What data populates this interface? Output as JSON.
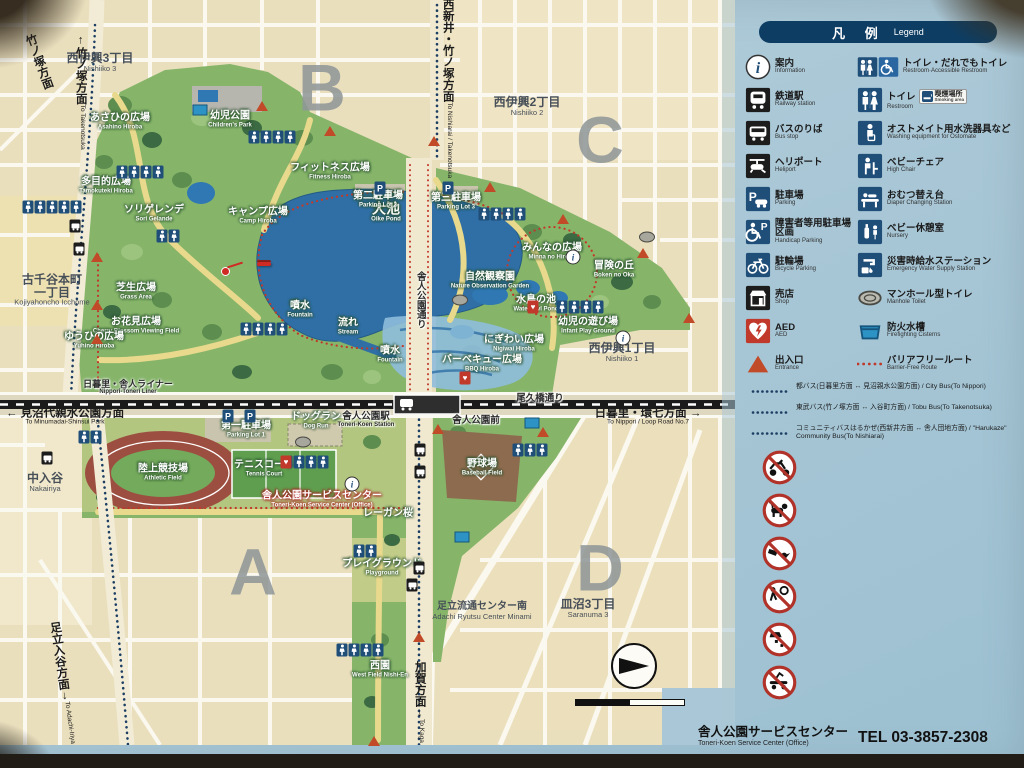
{
  "colors": {
    "accent_navy": "#0d3d63",
    "icon_blue": "#1f4e79",
    "icon_black": "#1c1c1c",
    "alert_red": "#c0392b",
    "prohibit_red": "#b03228",
    "entrance_orange": "#c14b28",
    "park_green": "#86b56a",
    "water_blue": "#2f6fa5",
    "map_cream": "#eadfbd",
    "sign_blue": "#a9c7d6",
    "route_red": "#c0392b",
    "route_navy": "#1c3e63"
  },
  "legend": {
    "title_jp": "凡 例",
    "title_en": "Legend",
    "left_items": [
      {
        "icon": "info",
        "jp": "案内",
        "en": "Information"
      },
      {
        "icon": "train",
        "jp": "鉄道駅",
        "en": "Railway station"
      },
      {
        "icon": "bus",
        "jp": "バスのりば",
        "en": "Bus stop"
      },
      {
        "icon": "heliport",
        "jp": "ヘリポート",
        "en": "Heliport"
      },
      {
        "icon": "parking",
        "jp": "駐車場",
        "en": "Parking"
      },
      {
        "icon": "handicap-parking",
        "jp": "障害者等用駐車場区画",
        "en": "Handicap Parking"
      },
      {
        "icon": "bicycle-parking",
        "jp": "駐輪場",
        "en": "Bicycle Parking"
      },
      {
        "icon": "shop",
        "jp": "売店",
        "en": "Shop"
      },
      {
        "icon": "aed",
        "jp": "AED",
        "en": "AED"
      },
      {
        "icon": "entrance",
        "jp": "出入口",
        "en": "Entrance"
      }
    ],
    "right_items": [
      {
        "icon": "restroom-accessible",
        "jp": "トイレ・だれでもトイレ",
        "en": "Restroom·Accessible Restroom"
      },
      {
        "icon": "restroom",
        "jp": "トイレ",
        "en": "Restroom",
        "badge_jp": "喫煙場所",
        "badge_en": "Smoking area"
      },
      {
        "icon": "ostomate",
        "jp": "オストメイト用水洗器具など",
        "en": "Washing equipment for Ostomate"
      },
      {
        "icon": "high-chair",
        "jp": "ベビーチェア",
        "en": "High Chair"
      },
      {
        "icon": "diaper",
        "jp": "おむつ替え台",
        "en": "Diaper Changing Station"
      },
      {
        "icon": "nursery",
        "jp": "ベビー休憩室",
        "en": "Nursery"
      },
      {
        "icon": "water-station",
        "jp": "災害時給水ステーション",
        "en": "Emergency Water Supply Station"
      },
      {
        "icon": "manhole-toilet",
        "jp": "マンホール型トイレ",
        "en": "Manhole Toilet"
      },
      {
        "icon": "cistern",
        "jp": "防火水槽",
        "en": "Firefighting Cisterns"
      },
      {
        "icon": "barrier-free",
        "jp": "バリアフリールート",
        "en": "Barrier-Free Route"
      }
    ],
    "bus_routes": [
      {
        "jp": "都バス(日暮里方面 ↔ 見沼親水公園方面)",
        "en": "City Bus(To Nippori)"
      },
      {
        "jp": "東武バス(竹ノ塚方面 ↔ 入谷町方面)",
        "en": "Tobu Bus(To Takenotsuka)"
      },
      {
        "jp": "コミュニティバスはるかぜ(西新井方面 ↔ 舎人団地方面)",
        "en": "\"Harukaze\" Community Bus(To Nishiarai)"
      }
    ],
    "prohibitions": [
      {
        "icon": "no-motorcycles",
        "jp": "バイクの乗り入れ禁止",
        "en": "No Motorcycles"
      },
      {
        "icon": "no-unleashed-dogs",
        "jp": "ペットの放飼い禁止",
        "en": "Dogs must be leashed"
      },
      {
        "icon": "no-feeding",
        "jp": "生物へのエサやり禁止",
        "en": "Do not feed animals"
      },
      {
        "icon": "no-ball-games",
        "jp": "野球・サッカー等のボール遊び禁止",
        "en": "No Ball Games"
      },
      {
        "icon": "no-littering",
        "jp": "ゴミのポイ捨て禁止",
        "en": "No Littering"
      },
      {
        "icon": "no-skateboarding",
        "jp": "スケートボード禁止",
        "en": "No Skateboarding"
      }
    ]
  },
  "footer": {
    "jp": "舎人公園サービスセンター",
    "en": "Toneri-Koen Service Center (Office)",
    "tel": "TEL 03-3857-2308"
  },
  "map": {
    "letters": [
      {
        "t": "B",
        "x": 322,
        "y": 88
      },
      {
        "t": "C",
        "x": 600,
        "y": 140
      },
      {
        "t": "A",
        "x": 253,
        "y": 572
      },
      {
        "t": "D",
        "x": 600,
        "y": 568
      }
    ],
    "districts": [
      {
        "jp": "西伊興3丁目",
        "en": "Nishiiko 3",
        "x": 100,
        "y": 62
      },
      {
        "jp": "西伊興2丁目",
        "en": "Nishiiko 2",
        "x": 527,
        "y": 106
      },
      {
        "jp": "西伊興1丁目",
        "en": "Nishiiko 1",
        "x": 622,
        "y": 352
      },
      {
        "jp": "古千谷本町",
        "jp2": "一丁目",
        "en": "Kojiyahoncho Icchome",
        "x": 52,
        "y": 290
      },
      {
        "jp": "中入谷",
        "en": "Nakairiya",
        "x": 45,
        "y": 482
      },
      {
        "jp": "皿沼3丁目",
        "en": "Saranuma 3",
        "x": 588,
        "y": 608
      },
      {
        "jp": "足立流通センター南",
        "en": "Adachi Ryutsu Center Minami",
        "x": 482,
        "y": 611,
        "small": true
      }
    ],
    "park_labels": [
      {
        "jp": "あさひの広場",
        "en": "Asahino Hiroba",
        "x": 120,
        "y": 122
      },
      {
        "jp": "幼児公園",
        "en": "Children's Park",
        "x": 230,
        "y": 120
      },
      {
        "jp": "多目的広場",
        "en": "Tamokuteki Hiroba",
        "x": 106,
        "y": 186
      },
      {
        "jp": "フィットネス広場",
        "en": "Fitness Hiroba",
        "x": 330,
        "y": 172
      },
      {
        "jp": "ソリゲレンデ",
        "en": "Sori Gelande",
        "x": 154,
        "y": 214
      },
      {
        "jp": "キャンプ広場",
        "en": "Camp Hiroba",
        "x": 258,
        "y": 216
      },
      {
        "jp": "大池",
        "en": "Oike Pond",
        "x": 386,
        "y": 212,
        "big": true
      },
      {
        "jp": "第二駐車場",
        "en": "Parking Lot 2",
        "x": 378,
        "y": 200
      },
      {
        "jp": "第三駐車場",
        "en": "Parking Lot 3",
        "x": 456,
        "y": 202
      },
      {
        "jp": "みんなの広場",
        "en": "Minna no Hiroba",
        "x": 552,
        "y": 252
      },
      {
        "jp": "冒険の丘",
        "en": "Boken no Oka",
        "x": 614,
        "y": 270
      },
      {
        "jp": "自然観察園",
        "en": "Nature Observation Garden",
        "x": 490,
        "y": 281
      },
      {
        "jp": "水鳥の池",
        "en": "Waterfowl Pond",
        "x": 536,
        "y": 304
      },
      {
        "jp": "幼児の遊び場",
        "en": "Infant Play Ground",
        "x": 588,
        "y": 326
      },
      {
        "jp": "にぎわい広場",
        "en": "Nigiwai Hiroba",
        "x": 514,
        "y": 344
      },
      {
        "jp": "バーベキュー広場",
        "en": "BBQ Hiroba",
        "x": 482,
        "y": 364
      },
      {
        "jp": "芝生広場",
        "en": "Grass Area",
        "x": 136,
        "y": 292
      },
      {
        "jp": "お花見広場",
        "en": "Cherry Blossom Viewing Field",
        "x": 136,
        "y": 326
      },
      {
        "jp": "ゆうひの広場",
        "en": "Yuhino Hiroba",
        "x": 94,
        "y": 341
      },
      {
        "jp": "噴水",
        "en": "Fountain",
        "x": 300,
        "y": 310
      },
      {
        "jp": "流れ",
        "en": "Stream",
        "x": 348,
        "y": 327
      },
      {
        "jp": "噴水",
        "en": "Fountain",
        "x": 390,
        "y": 355
      },
      {
        "jp": "ドッグラン",
        "en": "Dog Run",
        "x": 316,
        "y": 421
      },
      {
        "jp": "第一駐車場",
        "en": "Parking Lot 1",
        "x": 246,
        "y": 430
      },
      {
        "jp": "陸上競技場",
        "en": "Athletic Field",
        "x": 163,
        "y": 473
      },
      {
        "jp": "テニスコート",
        "en": "Tennis Court",
        "x": 264,
        "y": 469
      },
      {
        "jp": "舎人公園サービスセンター",
        "en": "Toneri-Koen Service Center (Office)",
        "x": 322,
        "y": 500,
        "svc": true
      },
      {
        "jp": "レーガン桜",
        "en": "",
        "x": 388,
        "y": 514
      },
      {
        "jp": "野球場",
        "en": "Baseball Field",
        "x": 482,
        "y": 468
      },
      {
        "jp": "プレイグラウンド",
        "en": "Playground",
        "x": 382,
        "y": 568
      },
      {
        "jp": "西園",
        "en": "West Field Nishi-En",
        "x": 380,
        "y": 670
      }
    ],
    "road_labels": [
      {
        "jp": "日暮里・舎人ライナー",
        "en": "Nippori-Toneri Liner",
        "x": 128,
        "y": 388,
        "rail": true
      },
      {
        "jp": "尾久橋通り",
        "en": "",
        "x": 540,
        "y": 399
      },
      {
        "jp": "舎人公園通り",
        "en": "",
        "x": 420,
        "y": 300,
        "vert": true
      },
      {
        "jp": "舎人公園駅",
        "en": "Toneri-Koen Station",
        "x": 366,
        "y": 420
      },
      {
        "jp": "舎人公園前",
        "en": "",
        "x": 476,
        "y": 421
      }
    ],
    "directions": [
      {
        "jp": "竹ノ塚方面",
        "en": "To Takenotsuka",
        "x": 80,
        "y": 92,
        "vert": true,
        "arrow": "↑"
      },
      {
        "jp": "竹ノ塚方面",
        "en": "",
        "x": 38,
        "y": 62,
        "vert": true,
        "arrow": "",
        "rot": -20
      },
      {
        "jp": "西新井・竹ノ塚方面",
        "en": "To Nishiarai / Takenotsuka",
        "x": 447,
        "y": 82,
        "vert": true,
        "arrow": "↑"
      },
      {
        "jp": "見沼代親水公園方面",
        "en": "To Minumadai-Shinsui Park",
        "x": 65,
        "y": 417,
        "arrow": "←"
      },
      {
        "jp": "日暮里・環七方面",
        "en": "To Nippori / Loop Road No.7",
        "x": 648,
        "y": 417,
        "arrow": "→"
      },
      {
        "jp": "加賀方面",
        "en": "To Kaga",
        "x": 419,
        "y": 702,
        "vert": true,
        "arrow": "↓"
      },
      {
        "jp": "足立入谷方面",
        "en": "To Adachi-Iriya",
        "x": 62,
        "y": 683,
        "vert": true,
        "arrow": "↓",
        "rot": -8
      },
      {
        "jp": "足立流通センター南",
        "en": "Adachi Ryutsu Center Minami",
        "x": 0,
        "y": 0,
        "hidden": true
      }
    ],
    "you_are_here": {
      "jp": "現在地",
      "en": "You are here",
      "x": 264,
      "y": 263,
      "dot_x": 224,
      "dot_y": 270
    },
    "compass": {
      "n": "N",
      "x": 634,
      "y": 666
    },
    "scale": {
      "x": 630,
      "y": 699,
      "ticks": [
        "0",
        "50",
        "100m"
      ]
    },
    "markers": [
      {
        "t": "wc",
        "x": 52,
        "y": 207,
        "n": 5
      },
      {
        "t": "wc",
        "x": 140,
        "y": 172,
        "n": 4
      },
      {
        "t": "wc",
        "x": 272,
        "y": 137,
        "n": 4
      },
      {
        "t": "wc",
        "x": 168,
        "y": 236,
        "n": 2
      },
      {
        "t": "wc",
        "x": 502,
        "y": 214,
        "n": 4
      },
      {
        "t": "wc",
        "x": 580,
        "y": 307,
        "n": 4
      },
      {
        "t": "wc",
        "x": 264,
        "y": 329,
        "n": 4
      },
      {
        "t": "wc",
        "x": 305,
        "y": 462,
        "n": 4
      },
      {
        "t": "wc",
        "x": 365,
        "y": 551,
        "n": 2
      },
      {
        "t": "wc",
        "x": 360,
        "y": 650,
        "n": 4
      },
      {
        "t": "wc",
        "x": 90,
        "y": 437,
        "n": 2
      },
      {
        "t": "wc",
        "x": 530,
        "y": 450,
        "n": 3
      },
      {
        "t": "aed",
        "x": 533,
        "y": 307
      },
      {
        "t": "aed",
        "x": 286,
        "y": 462
      },
      {
        "t": "aed",
        "x": 465,
        "y": 378
      },
      {
        "t": "info",
        "x": 573,
        "y": 257
      },
      {
        "t": "info",
        "x": 623,
        "y": 338
      },
      {
        "t": "info",
        "x": 352,
        "y": 484
      },
      {
        "t": "bus",
        "x": 75,
        "y": 226
      },
      {
        "t": "bus",
        "x": 79,
        "y": 249
      },
      {
        "t": "bus",
        "x": 47,
        "y": 458
      },
      {
        "t": "bus",
        "x": 420,
        "y": 450
      },
      {
        "t": "bus",
        "x": 420,
        "y": 472
      },
      {
        "t": "bus",
        "x": 419,
        "y": 568
      },
      {
        "t": "bus",
        "x": 412,
        "y": 585
      },
      {
        "t": "pk",
        "x": 380,
        "y": 188
      },
      {
        "t": "pk",
        "x": 448,
        "y": 188
      },
      {
        "t": "pk",
        "x": 228,
        "y": 416
      },
      {
        "t": "pk",
        "x": 250,
        "y": 416
      },
      {
        "t": "man",
        "x": 303,
        "y": 442
      },
      {
        "t": "man",
        "x": 647,
        "y": 237
      },
      {
        "t": "man",
        "x": 460,
        "y": 300
      },
      {
        "t": "cis",
        "x": 200,
        "y": 110
      },
      {
        "t": "cis",
        "x": 462,
        "y": 537
      },
      {
        "t": "cis",
        "x": 532,
        "y": 423
      },
      {
        "t": "ent",
        "x": 262,
        "y": 106
      },
      {
        "t": "ent",
        "x": 330,
        "y": 131
      },
      {
        "t": "ent",
        "x": 434,
        "y": 141
      },
      {
        "t": "ent",
        "x": 490,
        "y": 187
      },
      {
        "t": "ent",
        "x": 563,
        "y": 219
      },
      {
        "t": "ent",
        "x": 643,
        "y": 253
      },
      {
        "t": "ent",
        "x": 689,
        "y": 318
      },
      {
        "t": "ent",
        "x": 97,
        "y": 257
      },
      {
        "t": "ent",
        "x": 97,
        "y": 305
      },
      {
        "t": "ent",
        "x": 97,
        "y": 339
      },
      {
        "t": "ent",
        "x": 438,
        "y": 429
      },
      {
        "t": "ent",
        "x": 419,
        "y": 637
      },
      {
        "t": "ent",
        "x": 374,
        "y": 741
      },
      {
        "t": "ent",
        "x": 543,
        "y": 432
      }
    ]
  }
}
